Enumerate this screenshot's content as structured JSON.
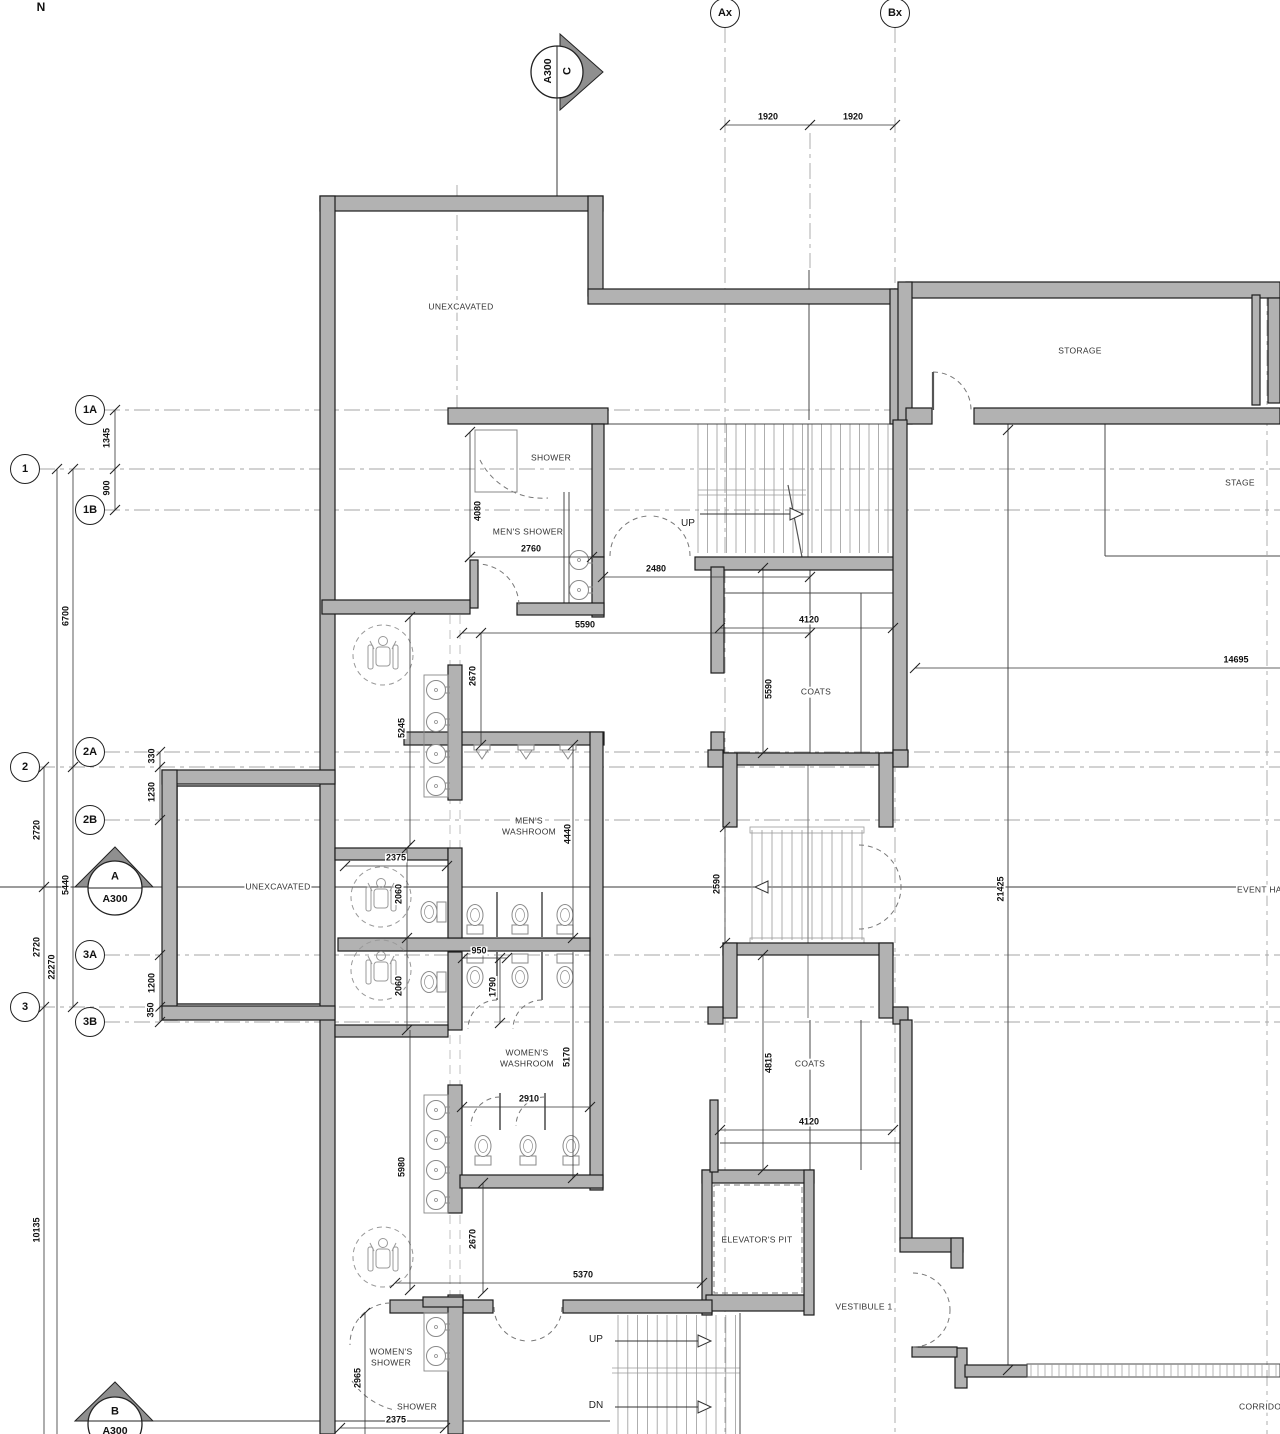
{
  "north_indicator": "N",
  "grid_bubbles": {
    "ax": "Ax",
    "bx": "Bx",
    "b1a": "1A",
    "b1": "1",
    "b1b": "1B",
    "b2a": "2A",
    "b2": "2",
    "b2b": "2B",
    "b3a": "3A",
    "b3": "3",
    "b3b": "3B"
  },
  "section_markers": {
    "c": {
      "letter": "C",
      "sheet": "A300"
    },
    "a": {
      "letter": "A",
      "sheet": "A300"
    },
    "b": {
      "letter": "B",
      "sheet": "A300"
    }
  },
  "rooms": {
    "unexcavated_top": "UNEXCAVATED",
    "storage": "STORAGE",
    "stage": "STAGE",
    "shower_top": "SHOWER",
    "mens_shower": "MEN'S SHOWER",
    "mens_washroom": "MEN'S WASHROOM",
    "unexcavated_left": "UNEXCAVATED",
    "womens_washroom": "WOMEN'S WASHROOM",
    "coats_upper": "COATS",
    "coats_lower": "COATS",
    "elevators_pit": "ELEVATOR'S PIT",
    "vestibule": "VESTIBULE 1",
    "event_hall": "EVENT HALL",
    "corridor": "CORRIDOR",
    "womens_shower": "WOMEN'S SHOWER",
    "shower_bottom": "SHOWER"
  },
  "stair_labels": {
    "up_main": "UP",
    "up_lower": "UP",
    "dn_lower": "DN"
  },
  "dimensions": {
    "ax_mid": "1920",
    "mid_bx": "1920",
    "d1345": "1345",
    "d900": "900",
    "d6700": "6700",
    "d5440": "5440",
    "d2720_upper": "2720",
    "d2720_lower": "2720",
    "d22270": "22270",
    "d10135": "10135",
    "d330": "330",
    "d1230": "1230",
    "d1200": "1200",
    "d350": "350",
    "d4080": "4080",
    "d2760": "2760",
    "d2480": "2480",
    "d5590_h": "5590",
    "d2670_upper": "2670",
    "d5245": "5245",
    "d2375_upper": "2375",
    "d2060_upper": "2060",
    "d2060_lower": "2060",
    "d4440": "4440",
    "d950": "950",
    "d1790": "1790",
    "d5170": "5170",
    "d2910": "2910",
    "d5980": "5980",
    "d2670_lower": "2670",
    "d5370": "5370",
    "d2965": "2965",
    "d2375_lower": "2375",
    "d4120_upper": "4120",
    "d5590_v": "5590",
    "d2590": "2590",
    "d4815": "4815",
    "d4120_lower": "4120",
    "d14695": "14695",
    "d21425": "21425"
  },
  "colors": {
    "wall_fill": "#b2b2b2",
    "wall_edge": "#1c1c1c",
    "grid_line": "#a6a6a6",
    "dim_line": "#333333",
    "fixture": "#8a8a8a"
  }
}
